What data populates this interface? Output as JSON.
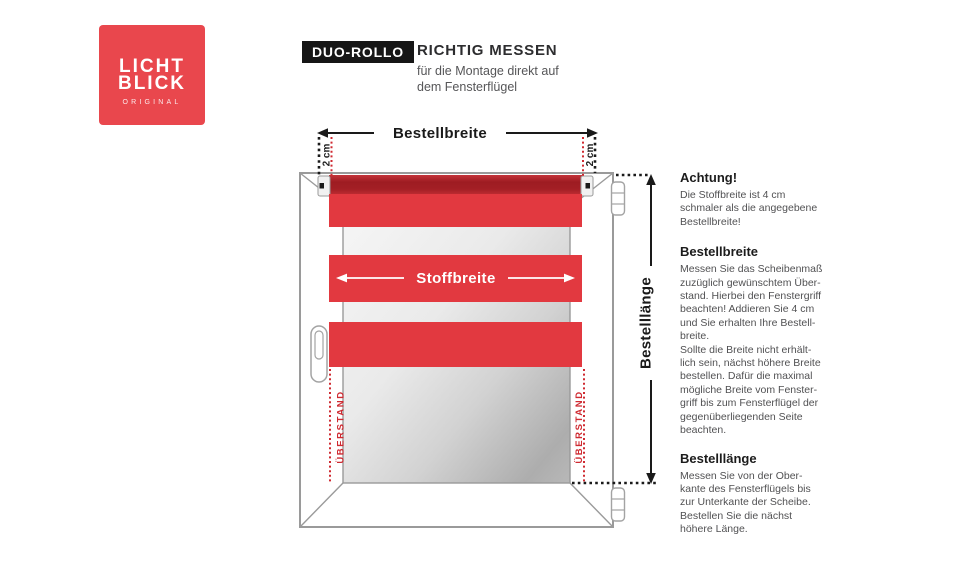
{
  "logo": {
    "line1": "LICHT",
    "line2": "BLICK",
    "subtext": "ORIGINAL",
    "color": "#e9474d"
  },
  "header": {
    "badge": "DUO-ROLLO",
    "title": "RICHTIG MESSEN",
    "subtitle": "für die Montage direkt auf\ndem Fensterflügel"
  },
  "diagram": {
    "bestellbreite_label": "Bestellbreite",
    "stoffbreite_label": "Stoffbreite",
    "bestelllaenge_label": "Bestelllänge",
    "two_cm_left": "2 cm",
    "two_cm_right": "2 cm",
    "ueberstand_left": "ÜBERSTAND",
    "ueberstand_right": "ÜBERSTAND",
    "colors": {
      "fabric_red": "#e23940",
      "tube_red": "#a01d23",
      "annotation_red": "#cf2a31",
      "measure_black": "#1a1a1a",
      "frame_gray": "#9a9a9a"
    }
  },
  "info": {
    "sections": [
      {
        "heading": "Achtung!",
        "body": "Die Stoffbreite ist 4 cm\nschmaler als die angegebene\nBestellbreite!"
      },
      {
        "heading": "Bestellbreite",
        "body": "Messen Sie das Scheibenmaß\nzuzüglich gewünschtem Über-\nstand. Hierbei den Fenstergriff\nbeachten! Addieren Sie 4 cm\nund Sie erhalten Ihre Bestell-\nbreite.\nSollte die Breite nicht erhält-\nlich sein, nächst höhere Breite\nbestellen. Dafür die maximal\nmögliche Breite vom Fenster-\ngriff bis zum Fensterflügel der\ngegenüberliegenden Seite\nbeachten."
      },
      {
        "heading": "Bestelllänge",
        "body": "Messen Sie von der Ober-\nkante des Fensterflügels bis\nzur Unterkante der Scheibe.\nBestellen Sie die nächst\nhöhere Länge."
      }
    ]
  }
}
